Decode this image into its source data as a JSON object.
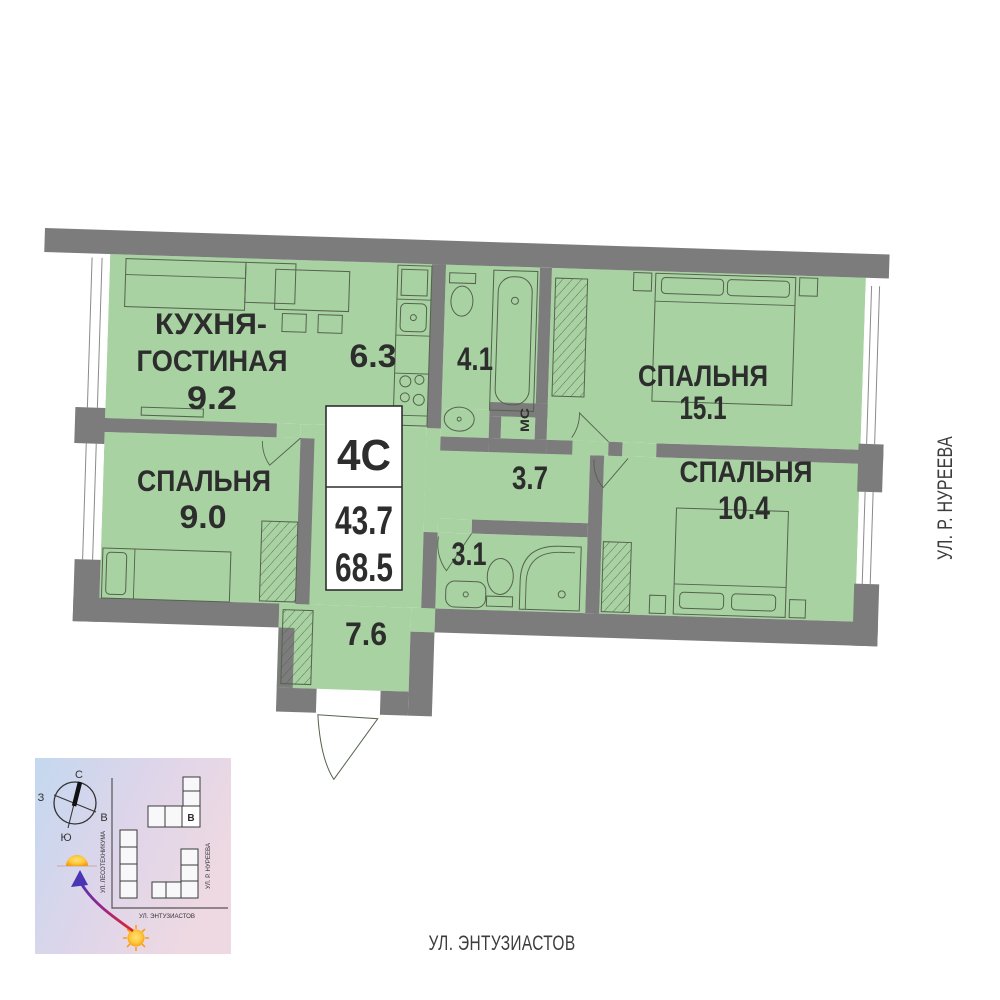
{
  "colors": {
    "room_fill": "#a8d2a2",
    "wall": "#7c7c7c",
    "furniture_line": "#55624f",
    "label_text": "#2d2d2d",
    "street_text": "#3c3c3c",
    "arrow_red": "#e02525",
    "arrow_blue": "#4a35b5",
    "sun_orange": "#f59a0c"
  },
  "unit_card": {
    "type": "4С",
    "living_area": "43.7",
    "total_area": "68.5"
  },
  "rooms": {
    "kitchen_living": {
      "name_line1": "КУХНЯ-",
      "name_line2": "ГОСТИНАЯ",
      "area": "9.2"
    },
    "kitchen_zone": {
      "area": "6.3"
    },
    "bathroom_main": {
      "area": "4.1"
    },
    "bedroom_large": {
      "name": "СПАЛЬНЯ",
      "area": "15.1"
    },
    "bedroom_left": {
      "name": "СПАЛЬНЯ",
      "area": "9.0"
    },
    "hallway": {
      "area": "3.7"
    },
    "bedroom_right": {
      "name": "СПАЛЬНЯ",
      "area": "10.4"
    },
    "bathroom_small": {
      "area": "3.1"
    },
    "entry_hall": {
      "area": "7.6"
    },
    "closet": {
      "label": "МС"
    }
  },
  "streets": {
    "right": "УЛ. Р. НУРЕЕВА",
    "bottom": "УЛ. ЭНТУЗИАСТОВ"
  },
  "minimap": {
    "compass": {
      "north": "С",
      "south": "Ю",
      "west": "З",
      "east": "В"
    },
    "building_label": "В",
    "street_left": "УЛ. ЛЕСОТЕХНИКУМА",
    "street_right": "УЛ. Р. НУРЕЕВА",
    "street_bottom": "УЛ. ЭНТУЗИАСТОВ"
  }
}
